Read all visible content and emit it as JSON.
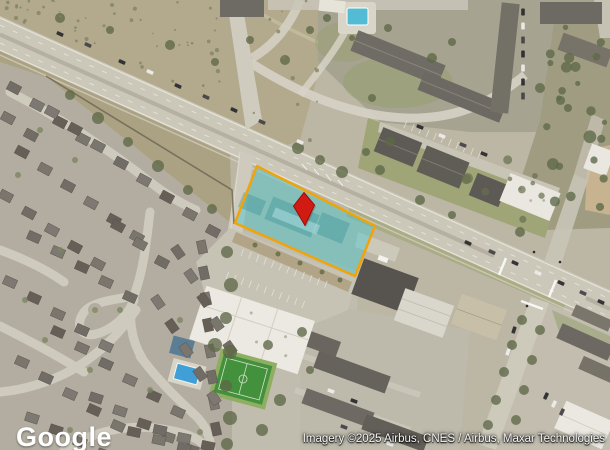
{
  "map": {
    "watermark": "Google",
    "attribution": "Imagery ©2025 Airbus, CNES / Airbus, Maxar Technologies",
    "overlay": {
      "parcel_fill": "#45c8d2",
      "parcel_fill_opacity": "0.45",
      "parcel_border": "#f0a40a",
      "marker_fill": "#d11a12",
      "marker_outline": "#9a0f0a"
    }
  }
}
